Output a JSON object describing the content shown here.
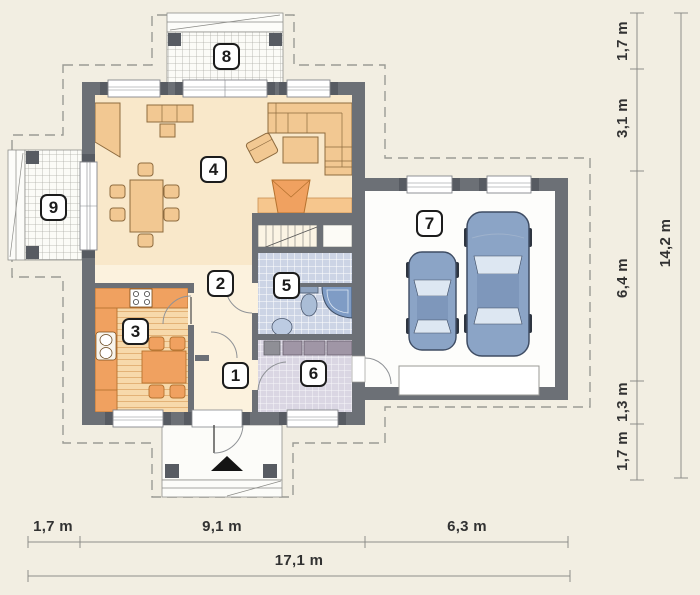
{
  "colors": {
    "bg": "#f2eee2",
    "wall": "#6c7076",
    "wall_dark": "#575b62",
    "floor_main": "#f9e8ca",
    "floor_hall": "#fcf2de",
    "terrace": "#fbfbf7",
    "grid": "#adada7",
    "tile5": "#ccd4e5",
    "tile6": "#dad6e3",
    "wood": "#f7d9ab",
    "wood_line": "#e3b277",
    "tan": "#f2c892",
    "orange": "#f0a160",
    "hearth": "#f6c68d",
    "car": "#8ba4c6",
    "glass": "#dde7f2",
    "dash": "#9b9b95",
    "dim": "#8d8d89",
    "text": "#323232"
  },
  "rooms": [
    {
      "number": "1"
    },
    {
      "number": "2"
    },
    {
      "number": "3"
    },
    {
      "number": "4"
    },
    {
      "number": "5"
    },
    {
      "number": "6"
    },
    {
      "number": "7"
    },
    {
      "number": "8"
    },
    {
      "number": "9"
    }
  ],
  "dims": {
    "right": [
      "1,7 m",
      "3,1 m",
      "6,4 m",
      "1,3 m",
      "1,7 m"
    ],
    "right_total": "14,2 m",
    "bottom": [
      "1,7 m",
      "9,1 m",
      "6,3 m"
    ],
    "bottom_total": "17,1 m"
  },
  "icons": {
    "entrance_arrow": "triangle-up"
  }
}
